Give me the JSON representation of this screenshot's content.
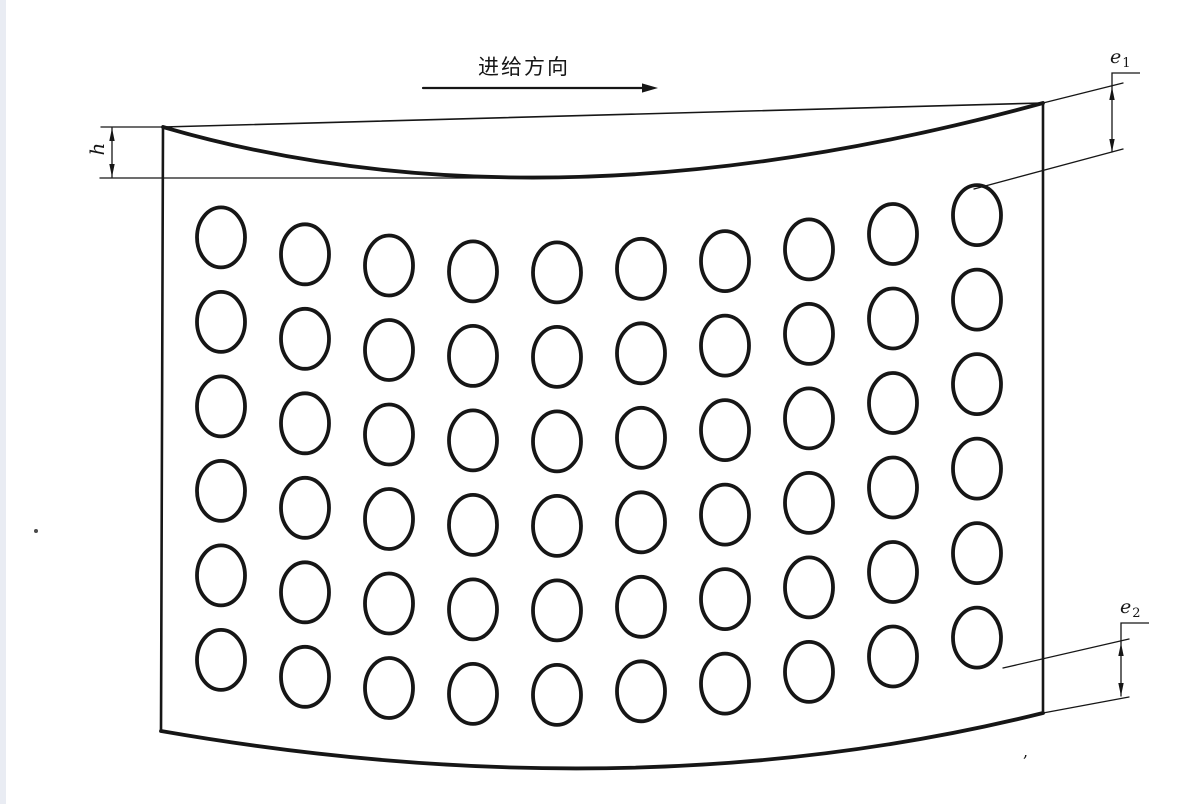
{
  "labels": {
    "feed_direction": "进给方向",
    "h": "h",
    "e1": {
      "base": "e",
      "sub": "1"
    },
    "e2": {
      "base": "e",
      "sub": "2"
    },
    "comma_mark": ","
  },
  "colors": {
    "background": "#ffffff",
    "ink": "#161616",
    "page_edge": "#e9ecf3"
  },
  "diagram": {
    "plate": {
      "top_left": [
        163,
        127
      ],
      "top_right": [
        1043,
        103
      ],
      "bottom_right": [
        1043,
        713
      ],
      "bottom_left": [
        161,
        731
      ],
      "top_curve_ctrl": [
        547,
        239
      ],
      "bottom_curve_ctrl": [
        637,
        814
      ]
    },
    "holes": {
      "columns_x": [
        221,
        305,
        389,
        473,
        557,
        641,
        725,
        809,
        893,
        977
      ],
      "row_count": 6,
      "row_spacing": 84.5,
      "first_row_center_offset": 95,
      "rx": 24,
      "ry": 30,
      "stroke_width": 3.8
    },
    "feed_arrow": {
      "x1": 423,
      "y": 88,
      "x2": 658,
      "head_len": 16,
      "head_half_w": 4.6
    },
    "dimensions": {
      "h": {
        "ext_lines": [
          [
            [
              101,
              127
            ],
            [
              168,
              127
            ]
          ],
          [
            [
              100,
              178
            ],
            [
              556,
              178
            ]
          ]
        ],
        "dim_line": {
          "x": 112,
          "y1": 128,
          "y2": 177
        },
        "leader": null
      },
      "e1": {
        "ext_lines": [
          [
            [
              1043,
              103
            ],
            [
              1123,
              83
            ]
          ],
          [
            [
              974,
              189
            ],
            [
              1123,
              149
            ]
          ]
        ],
        "dim_line": {
          "x": 1112,
          "y1": 87,
          "y2": 152
        },
        "leader": [
          [
            1112,
            87
          ],
          [
            1112,
            73
          ],
          [
            1140,
            73
          ]
        ]
      },
      "e2": {
        "ext_lines": [
          [
            [
              1003,
              668
            ],
            [
              1129,
              639
            ]
          ],
          [
            [
              1043,
              713
            ],
            [
              1129,
              697
            ]
          ]
        ],
        "dim_line": {
          "x": 1121,
          "y1": 643,
          "y2": 696
        },
        "leader": [
          [
            1121,
            643
          ],
          [
            1121,
            623
          ],
          [
            1149,
            623
          ]
        ]
      }
    },
    "artifacts": {
      "dot_pos": [
        36,
        531
      ],
      "comma_pos": [
        1023,
        757
      ]
    }
  }
}
